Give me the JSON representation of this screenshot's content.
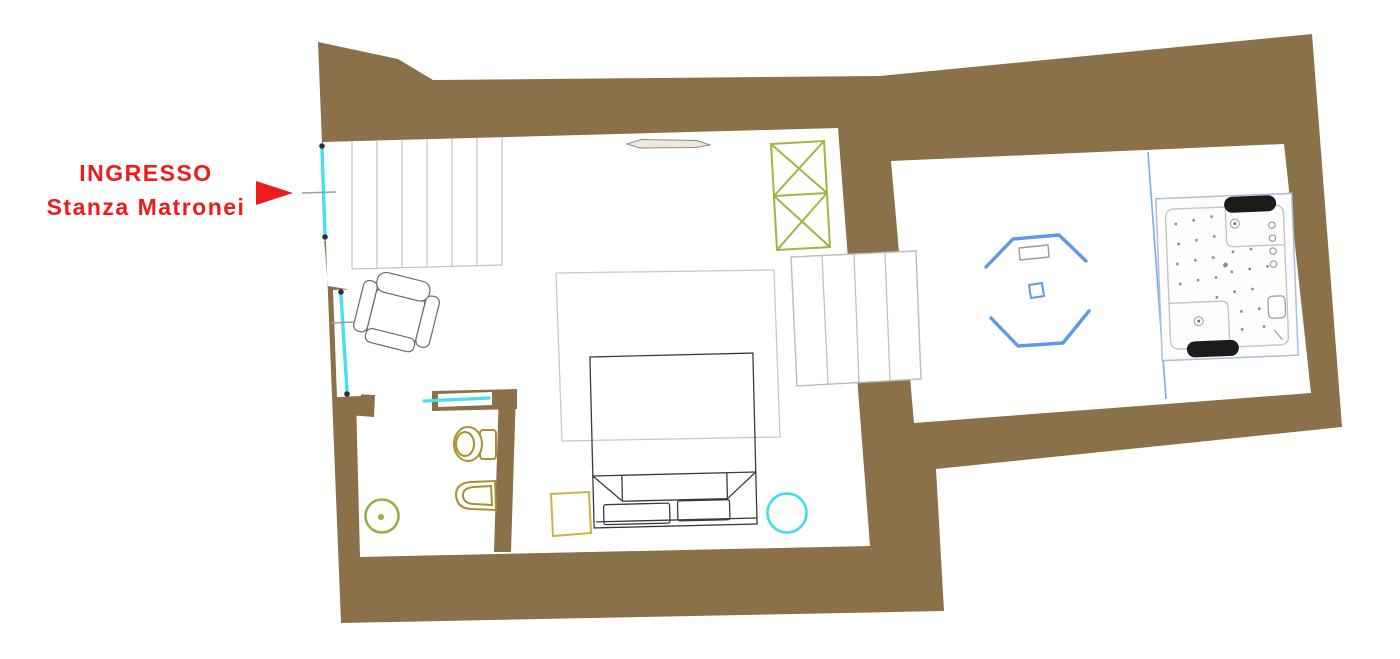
{
  "title": "Planimetria Stanza Matronei",
  "labels": {
    "entrance_line1": "INGRESSO",
    "entrance_line2": "Stanza Matronei"
  },
  "colors": {
    "wall": "#8a7149",
    "label_red": "#ee1b1b",
    "door_cyan": "#48dfee",
    "wardrobe_green": "#a6b243",
    "octagon_blue": "#5b9be4",
    "divider_blue": "#7aade9",
    "fixture_olive": "#a8922f",
    "drain_olive": "#a3a74b",
    "table_yellow": "#c6b83c",
    "stool_cyan": "#43dbe8",
    "line_gray": "#c2c2c2",
    "bed_dark": "#3a3a3a"
  },
  "plan_items": [
    "entrance-door",
    "side-window",
    "stairs-hatch",
    "radiator",
    "wardrobe",
    "armchair",
    "rug",
    "double-bed",
    "bedside-table",
    "stool",
    "bathroom-sliding-door",
    "toilet",
    "bidet",
    "floor-drain",
    "steps-passage",
    "room-divider",
    "octagon-feature",
    "jacuzzi"
  ]
}
